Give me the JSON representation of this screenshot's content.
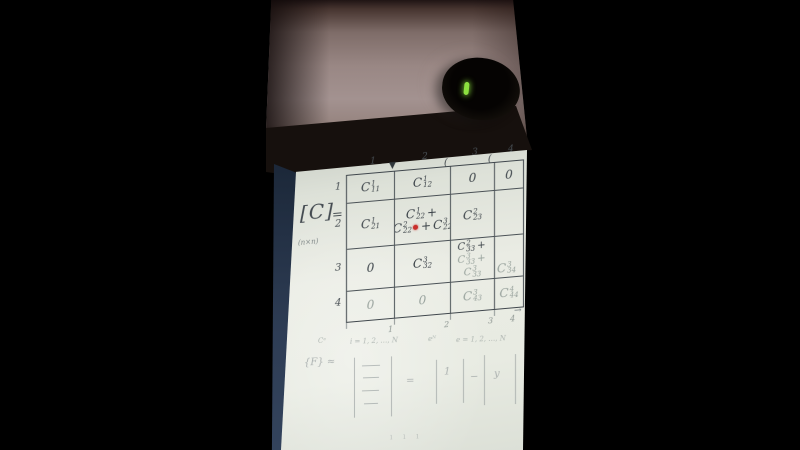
{
  "colors": {
    "red_dot": "#c92f2b",
    "led_green": "#8ce03f",
    "pen": "#3a4147",
    "paper": "#e9ece4"
  },
  "matrix_notation": {
    "bracket_label": "[C]",
    "dimension_label": "(n×n)",
    "equals": "="
  },
  "table": {
    "column_headers": [
      "1",
      "2",
      "3",
      "4"
    ],
    "row_labels": [
      "1",
      "2",
      "3",
      "4"
    ],
    "top_marks": [
      "▼",
      "(",
      "("
    ],
    "bottom_ticks": [
      "1",
      "2",
      "3",
      "4"
    ],
    "bottom_arrow": "→",
    "cells": [
      [
        [
          {
            "t": "C^1_11"
          }
        ],
        [
          {
            "t": "C^1_12"
          }
        ],
        [
          {
            "t": "0"
          }
        ],
        [
          {
            "t": "0"
          }
        ]
      ],
      [
        [
          {
            "t": "C^1_21"
          }
        ],
        [
          {
            "t": "C^1_22 +"
          },
          {
            "t": "C^2_22 ® + C^3_22"
          }
        ],
        [
          {
            "t": "C^2_23"
          }
        ],
        []
      ],
      [
        [
          {
            "t": "0"
          }
        ],
        [
          {
            "t": "C^3_32"
          }
        ],
        [
          {
            "t": "C^2_33 +"
          },
          {
            "t": "C^3_33 +",
            "f": true
          },
          {
            "t": "C^3_33",
            "f": true
          }
        ],
        [
          {
            "t": "C^3_34",
            "f": true
          }
        ]
      ],
      [
        [
          {
            "t": "0",
            "f": true
          }
        ],
        [
          {
            "t": "0",
            "f": true
          }
        ],
        [
          {
            "t": "C^3_43",
            "f": true
          }
        ],
        [
          {
            "t": "C^4_44",
            "f": true
          }
        ]
      ]
    ]
  },
  "notes": {
    "index_note_left": "Cᵉ",
    "index_note_mid": "i = 1, 2, …, N",
    "index_note_e": "eᴺ",
    "index_note_right": "e = 1, 2, …, N",
    "equation_label": "{F} ≈",
    "equation_equals": "=",
    "equation_entry_one": "1",
    "equation_minus": "−",
    "equation_entry_y": "y",
    "stray_marks": "ı ı ı"
  }
}
